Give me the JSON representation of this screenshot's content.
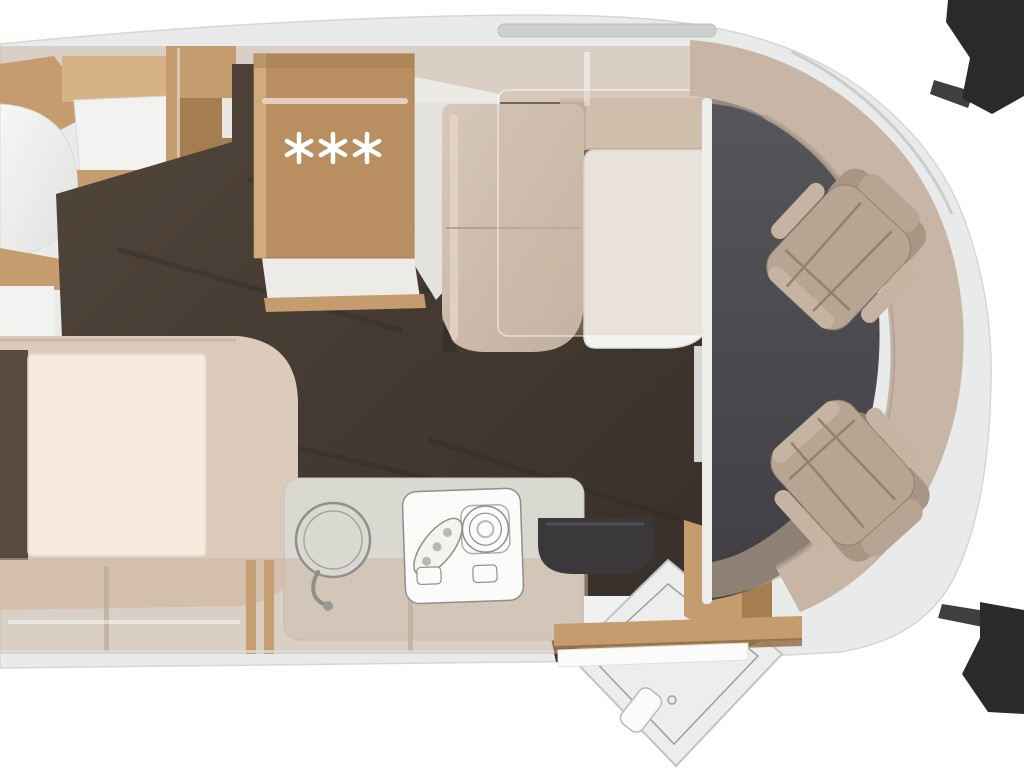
{
  "fridge": {
    "icon": "snowflake-icon",
    "count": 3,
    "spacing": 34,
    "radius": 14
  },
  "colors": {
    "background": "#ffffff",
    "body": "#e9eaea",
    "body_edge": "#d5d7d6",
    "roof_rail": "#cdd0cf",
    "roof_rail_edge": "#bcc0bf",
    "band": "rgba(201,180,158,0.5)",
    "wall": "rgba(190,168,146,0.62)",
    "wood": "#c49c6e",
    "wood_light": "#d7b286",
    "wood_dark": "#a57e50",
    "wood_deep": "#8f6a3e",
    "fridge_wood": "#b98e60",
    "rail_rod": "#e9dcc8",
    "step": "#ecebe7",
    "floor_a": "#52463c",
    "floor_b": "#362e27",
    "floor_streak": "#2e2721",
    "cab_a": "#56565b",
    "cab_b": "#3e3e43",
    "separator": "#ededeb",
    "mattress": "#f6eade",
    "mattress_edge": "#e7d6c9",
    "bed_base": "#dccaba",
    "bed_base_edge": "#c9b7a7",
    "bed_gap": "#584a40",
    "bench_seam": "#b3a190",
    "bench_notch": "#38312b",
    "table": "#f3f3f1",
    "table_edge": "#dddcd8",
    "table_leg": "#e8e8e4",
    "dropbed": "rgba(208,189,170,0.32)",
    "dropbed_edge": "rgba(255,255,255,0.55)",
    "sideboard": "rgba(203,184,164,0.85)",
    "band_divider": "rgba(190,175,160,0.8)",
    "band_shelf": "rgba(255,255,255,0.45)",
    "counter": "#d9d8d1",
    "counter_edge": "#c6c5be",
    "appliance": "#fbfbfa",
    "appliance_line": "#8f8f8a",
    "appliance_soft": "#b9b9b4",
    "sink_line": "#90908b",
    "sink_inner": "#a6a6a1",
    "toilet": "#3a383a",
    "toilet_hi": "#56545b",
    "shower": "#eceeee",
    "shower_line": "#9aa0a0",
    "shower_edge": "#c0c4c4",
    "entry": "#eff0ef",
    "dashboard": "#c7b5a5",
    "dashboard_rim": "#b19e8e",
    "seat": "#b7a493",
    "seat_dark": "#a89584",
    "seat_light": "#c6b4a3",
    "seat_line": "#93816f",
    "mirror": "#2a2a2c",
    "white_panel": "#f2f2f0",
    "panel_shade": "#d9dad9",
    "windshield_line": "#c3c6c5",
    "sill": "#d9dbda",
    "snowflake": "#ffffff"
  }
}
